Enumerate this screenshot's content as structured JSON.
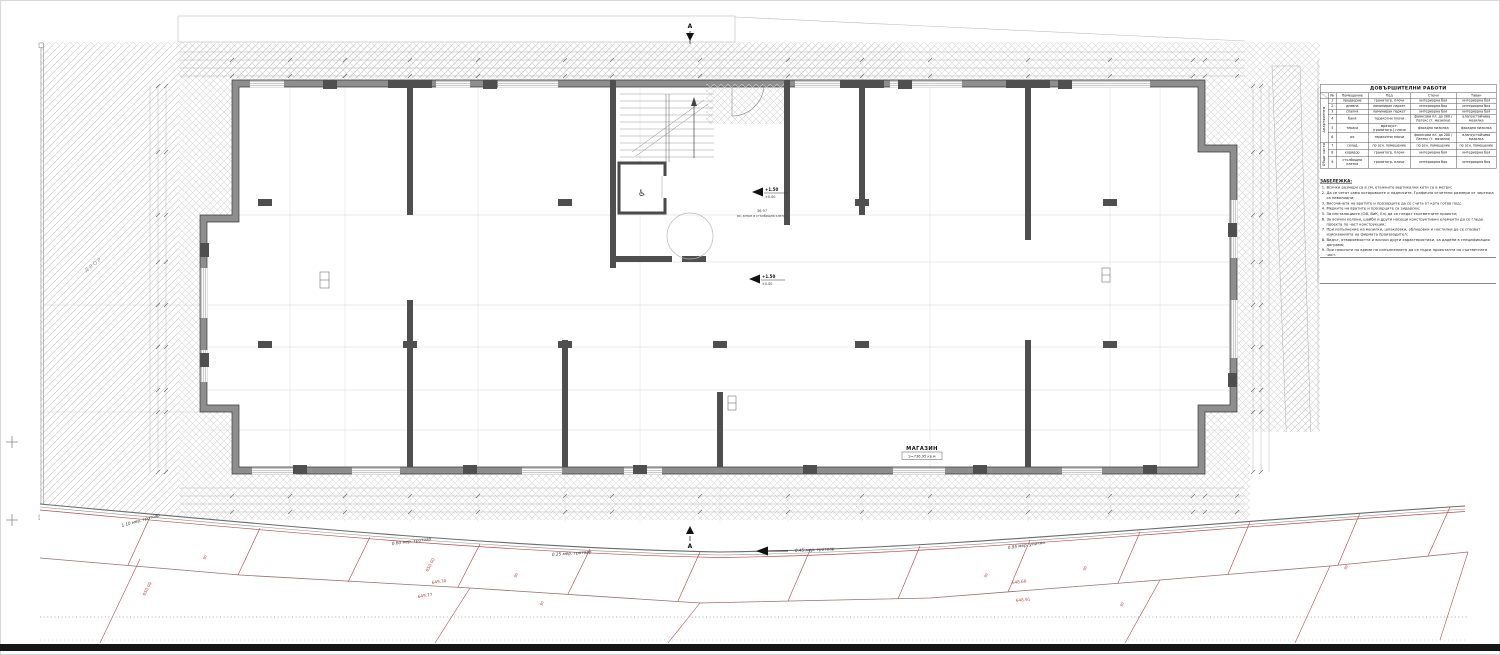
{
  "colors": {
    "red": "#b04848",
    "ink": "#222222",
    "wall_dark": "#4f4f4f",
    "band": "#6a6a6a"
  },
  "plan": {
    "shop": {
      "label": "МАГАЗИН",
      "area": "S=736.95 кв.м"
    },
    "stair": {
      "area": "36.97",
      "caption": "вх. антре и стълбищна клетка"
    },
    "levels": [
      {
        "main": "+1.50",
        "sub": "±0.00"
      },
      {
        "main": "+1.50",
        "sub": "±0.00"
      }
    ],
    "yard_label": "ДВОР",
    "section_mark": "А",
    "wheelchair_icon": "♿"
  },
  "survey": {
    "curb_labels": [
      {
        "text": "1.10 мер. тротоар",
        "x": 122,
        "y": 527,
        "r": -16
      },
      {
        "text": "0.60 мер. тротоар",
        "x": 392,
        "y": 545,
        "r": -7
      },
      {
        "text": "0.25 мер. тротоар",
        "x": 552,
        "y": 556,
        "r": -4
      },
      {
        "text": "0.45 мер. тротоар",
        "x": 795,
        "y": 552,
        "r": -3
      },
      {
        "text": "0.95 мер. улично",
        "x": 1008,
        "y": 549,
        "r": -8
      }
    ],
    "spot_elevations": [
      {
        "text": "650.09",
        "x": 145,
        "y": 596,
        "r": -62
      },
      {
        "text": "650.00",
        "x": 428,
        "y": 572,
        "r": -62
      },
      {
        "text": "649.30",
        "x": 432,
        "y": 584,
        "r": -8
      },
      {
        "text": "649.77",
        "x": 418,
        "y": 598,
        "r": -8
      },
      {
        "text": "648.66",
        "x": 1012,
        "y": 584,
        "r": -6
      },
      {
        "text": "648.91",
        "x": 1016,
        "y": 602,
        "r": -6
      }
    ],
    "width_marks": [
      {
        "text": "90",
        "x": 205,
        "y": 560,
        "r": -62
      },
      {
        "text": "90",
        "x": 516,
        "y": 578,
        "r": -62
      },
      {
        "text": "90",
        "x": 542,
        "y": 606,
        "r": -62
      },
      {
        "text": "90",
        "x": 986,
        "y": 578,
        "r": -62
      },
      {
        "text": "90",
        "x": 1085,
        "y": 571,
        "r": -62
      },
      {
        "text": "90",
        "x": 1122,
        "y": 607,
        "r": -62
      },
      {
        "text": "90",
        "x": 1346,
        "y": 570,
        "r": -62
      }
    ]
  },
  "table": {
    "title": "ДОВЪРШИТЕЛНИ РАБОТИ",
    "headers": [
      "№",
      "Помещение",
      "Под",
      "Стени",
      "Таван"
    ],
    "groups": [
      {
        "label": "Апартаменти",
        "span": 6
      },
      {
        "label": "Общи части",
        "span": 3
      }
    ],
    "rows": [
      {
        "num": "1",
        "room": "предверие",
        "floor": "гранитогр. плочи",
        "walls": "интериорна боя",
        "ceiling": "интериорна боя"
      },
      {
        "num": "2",
        "room": "дневна",
        "floor": "ламиниран паркет",
        "walls": "интериорна боя",
        "ceiling": "интериорна боя"
      },
      {
        "num": "3",
        "room": "спалня",
        "floor": "ламиниран паркет",
        "walls": "интериорна боя",
        "ceiling": "интериорна боя"
      },
      {
        "num": "4",
        "room": "баня",
        "floor": "теракотни плочи",
        "walls": "фаянсови пл. до 200 / Латекс (т. мазилка)",
        "ceiling": "влагоустойчива мазилка"
      },
      {
        "num": "5",
        "room": "тераса",
        "floor": "мразоуст. (гранитогр.) плочи",
        "walls": "фасадна мазилка",
        "ceiling": "фасадна мазилка"
      },
      {
        "num": "6",
        "room": "wc",
        "floor": "теракотни плочи",
        "walls": "фаянсови пл. до 200 / Латекс (т. мазилка)",
        "ceiling": "влагоустойчива мазилка"
      },
      {
        "num": "7",
        "room": "склад",
        "floor": "по осн. помещение",
        "walls": "по осн. помещение",
        "ceiling": "по осн. помещение"
      },
      {
        "num": "8",
        "room": "коридор",
        "floor": "гранитогр. плочи",
        "walls": "интериорна боя",
        "ceiling": "интериорна боя"
      },
      {
        "num": "9",
        "room": "стълбищна клетка",
        "floor": "гранитогр. плочи",
        "walls": "интериорна боя",
        "ceiling": "интериорна боя"
      }
    ]
  },
  "notes": {
    "heading": "ЗАБЕЛЕЖКА:",
    "items": [
      "Всички размери са в см, етажните вертикални коти са в метри;",
      "Да се четат само котировките и надписите. Графично отчетени размери от чертежа са невалидни;",
      "Височината на вратите и прозорците да се счита от кота готов под;",
      "Мерките на вратите и прозорците са зидарски;",
      "За инсталациите (ОВ, ВиК, Ел) да се гледат съответните проекти;",
      "За всички колони, шайби и други носещи конструктивни елементи да се гледа проекта по част конструкции;",
      "При изпълнение на мазилки, шпакловки, облицовки и настилки да се спазват изискванията на фирмата производител;",
      "Видът, отваряемостта и всички други характеристики, са дадени в спецификация дограма;",
      "При неясноти по време на изпълнението да се търси проектанта по съответната част."
    ]
  }
}
